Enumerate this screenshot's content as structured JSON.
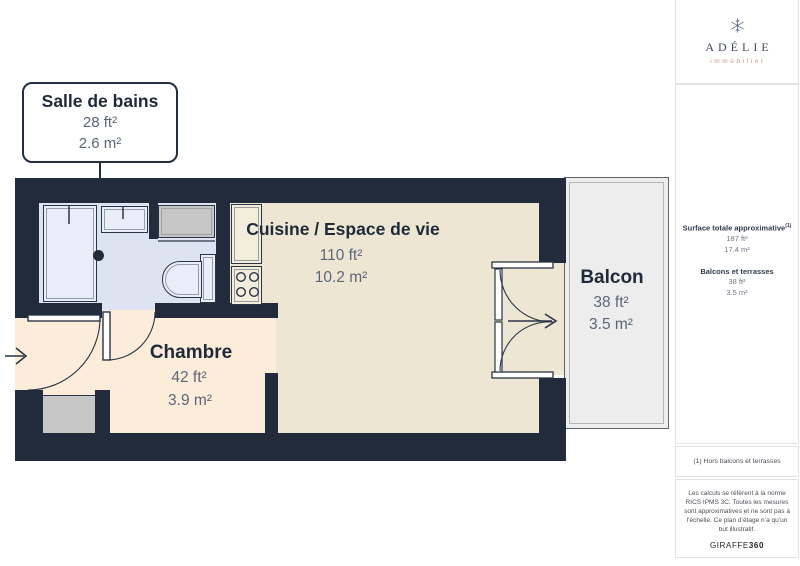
{
  "colors": {
    "wall": "#212b3b",
    "bathroom_floor": "#dde3f1",
    "kitchen_floor": "#ece6d2",
    "bedroom_floor": "#fcedda",
    "balcony_floor": "#ededed",
    "label_dark": "#1e2a3a",
    "label_gray": "#5c6678",
    "brand_accent": "#cf9189"
  },
  "plan": {
    "callout": {
      "title": "Salle de bains",
      "area_ft": "28 ft²",
      "area_m": "2.6 m²"
    },
    "rooms": {
      "cuisine": {
        "name": "Cuisine / Espace de vie",
        "area_ft": "110 ft²",
        "area_m": "10.2 m²"
      },
      "chambre": {
        "name": "Chambre",
        "area_ft": "42 ft²",
        "area_m": "3.9 m²"
      },
      "balcon": {
        "name": "Balcon",
        "area_ft": "38 ft²",
        "area_m": "3.5 m²"
      }
    }
  },
  "sidebar": {
    "logo": {
      "brand": "ADÉLIE",
      "subtitle": "immobilier"
    },
    "summary": {
      "total_label": "Surface totale approximative",
      "total_footnote_marker": "(1)",
      "total_ft": "187 ft²",
      "total_m": "17.4 m²",
      "terrace_label": "Balcons et terrasses",
      "terrace_ft": "38 ft²",
      "terrace_m": "3.5 m²"
    },
    "footnote": "(1) Hors balcons et terrasses",
    "disclaimer": "Les calculs se réfèrent à la norme RICS IPMS 3C. Toutes les mesures sont approximatives et ne sont pas à l’échelle. Ce plan d’étage n’a qu’un but illustratif.",
    "brand_footer": {
      "regular": "GIRAFFE",
      "bold": "360"
    }
  }
}
